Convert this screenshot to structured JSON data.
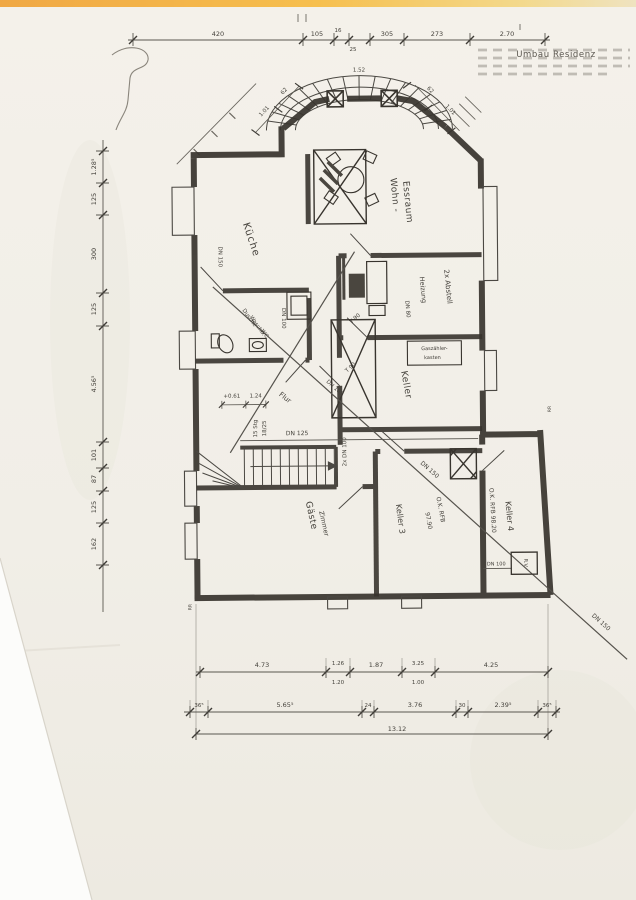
{
  "note": {
    "title": "Umbau Residenz"
  },
  "rooms": {
    "kueche": "Küche",
    "wohn_1": "Wohn -",
    "wohn_2": "Essraum",
    "abstell": "2x Abstell",
    "heizung": "Heizung",
    "keller": "Keller",
    "keller3": "Keller 3",
    "keller4": "Keller 4",
    "flur": "Flur",
    "gaeste_1": "Gäste",
    "gaeste_2": "Zimmer",
    "bad_1": "Dusche",
    "bad_2": "Waschb.",
    "bad_3": "WC"
  },
  "labels": {
    "gas_1": "Gaszähler-",
    "gas_2": "kasten",
    "rfb97_1": "O.K. RFB",
    "rfb97_2": "97.90",
    "rfb98": "O.K. RFB 98.20",
    "stair_1": "15 Stg",
    "stair_2": "18/25",
    "door_a": "T 90",
    "door_b": "T 90",
    "level": "+0.61",
    "level_dim": "1.24",
    "rv": "R.V.",
    "rr_a": "RR",
    "rr_b": "RR"
  },
  "pipes": {
    "dn150_wall": "DN 150",
    "dn150_diag": "DN 150",
    "dn150_end": "DN 150",
    "dn125": "DN 125",
    "dn100_diag": "DN 100",
    "dn100_2x": "2x DN 100",
    "dn100_bad": "DN 100",
    "dn100_annex": "DN 100",
    "dn80": "DN 80"
  },
  "dims": {
    "top": [
      "420",
      "105",
      "16",
      "25",
      "305",
      "273",
      "2.70"
    ],
    "left": [
      "1.28⁵",
      "125",
      "300",
      "125",
      "4.56⁵",
      "101",
      "87",
      "125",
      "162"
    ],
    "bottom_a": [
      "4.73",
      "1.26",
      "1.20",
      "1.87",
      "3.25",
      "1.00",
      "4.25"
    ],
    "bottom_b": [
      "36⁵",
      "5.65⁵",
      "24",
      "3.76",
      "30",
      "2.39⁵",
      "36⁵"
    ],
    "total": "13.12",
    "bay": [
      "1.01",
      "62",
      "1.52",
      "62",
      "1.01"
    ]
  }
}
